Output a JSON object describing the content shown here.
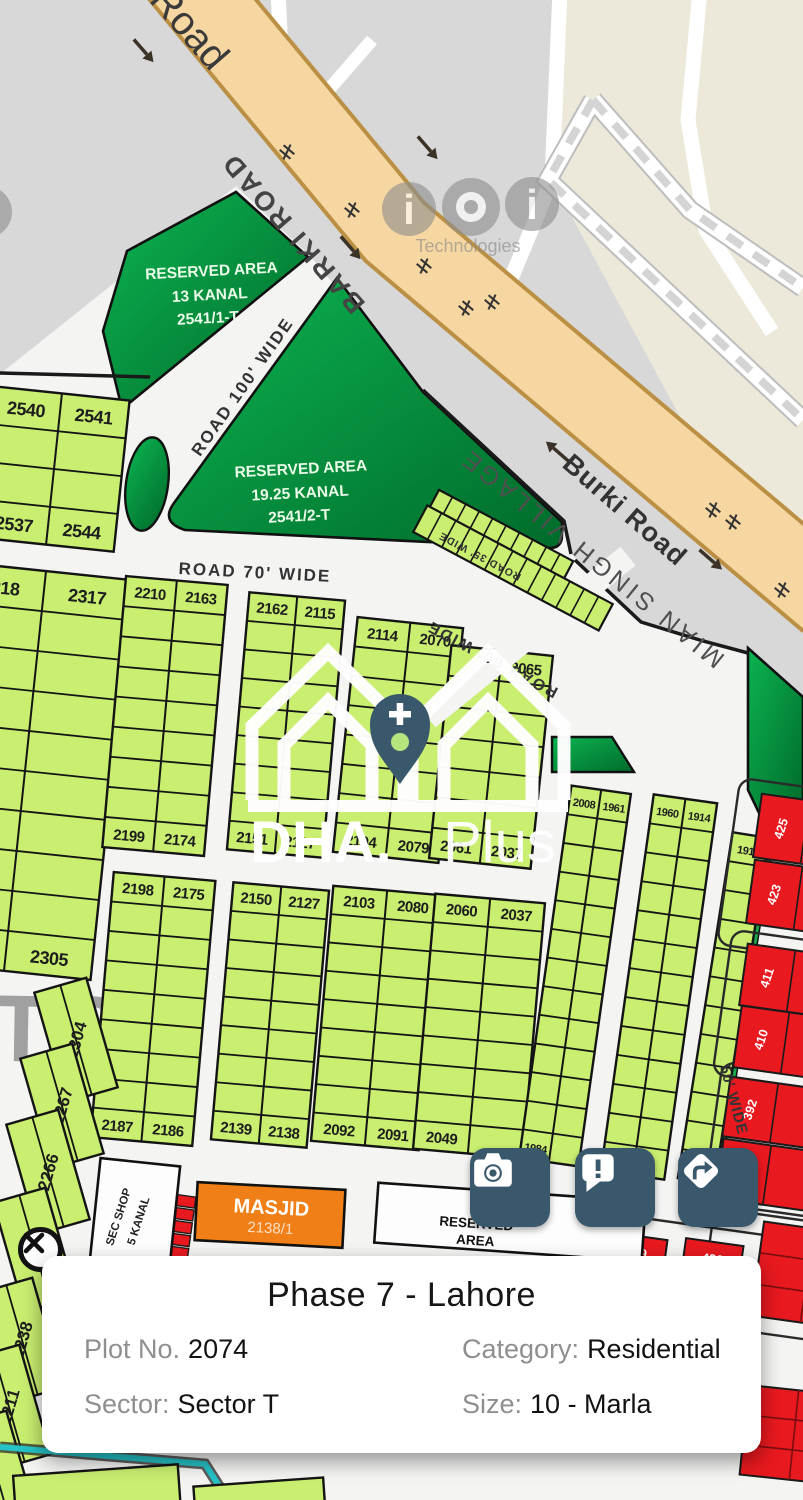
{
  "map": {
    "roads": {
      "burki": "Burki Road",
      "barki": "BARKI ROAD",
      "road100": "ROAD 100' WIDE",
      "road70": "ROAD 70' WIDE",
      "road60": "ROAD 60' WIDE",
      "road50": "50' WIDE",
      "road35": "ROAD 35' WIDE"
    },
    "village": "MIAN SINGH VILLAGE",
    "sector_watermark": "TOR",
    "reserved1": {
      "l1": "RESERVED AREA",
      "l2": "13 KANAL",
      "l3": "2541/1-T"
    },
    "reserved2": {
      "l1": "RESERVED AREA",
      "l2": "19.25 KANAL",
      "l3": "2541/2-T"
    },
    "reserved_bottom": {
      "l1": "RESERVED",
      "l2": "AREA"
    },
    "masjid": {
      "l1": "MASJID",
      "l2": "2138/1"
    },
    "secshop": {
      "l1": "SEC SHOP",
      "l2": "5 KANAL"
    },
    "watermark": {
      "brand_bold": "DHA.",
      "brand_light": "Plus",
      "tech": "Technologies",
      "i_glyph": "i"
    },
    "geometry": {
      "blocks": [
        {
          "x": -14,
          "y": 393,
          "w": 136,
          "h": 152,
          "rot": 6,
          "rows": 4,
          "cols": 2,
          "tl": "2540",
          "tr": "2541",
          "bl": "2537",
          "br": "2544",
          "fs": 18
        },
        {
          "x": -62,
          "y": 570,
          "w": 174,
          "h": 402,
          "rot": 6,
          "rows": 10,
          "cols": 2,
          "tl": "2318",
          "tr": "2317",
          "bl": "",
          "br": "2305",
          "fs": 18
        },
        {
          "x": 114,
          "y": 580,
          "w": 102,
          "h": 272,
          "rot": 5,
          "rows": 9,
          "cols": 2,
          "tl": "2210",
          "tr": "2163",
          "bl": "2199",
          "br": "2174",
          "fs": 15
        },
        {
          "x": 102,
          "y": 876,
          "w": 102,
          "h": 266,
          "rot": 5,
          "rows": 9,
          "cols": 2,
          "tl": "2198",
          "tr": "2175",
          "bl": "2187",
          "br": "2186",
          "fs": 15
        },
        {
          "x": 238,
          "y": 596,
          "w": 96,
          "h": 258,
          "rot": 5,
          "rows": 9,
          "cols": 2,
          "tl": "2162",
          "tr": "2115",
          "bl": "2151",
          "br": "2127",
          "fs": 15
        },
        {
          "x": 222,
          "y": 886,
          "w": 96,
          "h": 258,
          "rot": 5,
          "rows": 9,
          "cols": 2,
          "tl": "2150",
          "tr": "2127",
          "bl": "2139",
          "br": "2138",
          "fs": 15
        },
        {
          "x": 345,
          "y": 622,
          "w": 106,
          "h": 236,
          "rot": 6,
          "rows": 8,
          "cols": 2,
          "tl": "2114",
          "tr": "2070",
          "bl": "2104",
          "br": "2079",
          "fs": 15
        },
        {
          "x": 322,
          "y": 890,
          "w": 108,
          "h": 256,
          "rot": 5,
          "rows": 9,
          "cols": 2,
          "tl": "2103",
          "tr": "2080",
          "bl": "2092",
          "br": "2091",
          "fs": 15
        },
        {
          "x": 440,
          "y": 650,
          "w": 102,
          "h": 214,
          "rot": 6,
          "rows": 7,
          "cols": 2,
          "tl": "",
          "tr": "2065",
          "bl": "2061",
          "br": "2037",
          "fs": 15
        },
        {
          "x": 424,
          "y": 898,
          "w": 110,
          "h": 256,
          "rot": 5,
          "rows": 9,
          "cols": 2,
          "tl": "2060",
          "tr": "2037",
          "bl": "2049",
          "br": "",
          "fs": 15
        },
        {
          "x": 545,
          "y": 788,
          "w": 60,
          "h": 376,
          "rot": 8,
          "rows": 13,
          "cols": 2,
          "tl": "2008",
          "tr": "1961",
          "bl": "1984",
          "br": "",
          "fs": 11
        },
        {
          "x": 627,
          "y": 797,
          "w": 64,
          "h": 380,
          "rot": 8,
          "rows": 13,
          "cols": 2,
          "tl": "1960",
          "tr": "1914",
          "bl": "",
          "br": "",
          "fs": 11
        },
        {
          "x": 705,
          "y": 833,
          "w": 37,
          "h": 350,
          "rot": 9,
          "rows": 12,
          "cols": 1,
          "tl": "1913",
          "tr": "",
          "bl": "",
          "br": "",
          "fs": 11
        }
      ],
      "strips": [
        {
          "x": 424,
          "y": 524,
          "w": 152,
          "h": 26,
          "rot": 28,
          "vcols": 10
        },
        {
          "x": 408,
          "y": 553,
          "w": 210,
          "h": 30,
          "rot": 28,
          "vcols": 13
        }
      ],
      "rot_plots": [
        {
          "n": "2304",
          "cx": 76,
          "cy": 1040
        },
        {
          "n": "2267",
          "cx": 62,
          "cy": 1106
        },
        {
          "n": "2266",
          "cx": 48,
          "cy": 1172
        },
        {
          "n": "2239",
          "cx": 35,
          "cy": 1250
        },
        {
          "n": "2238",
          "cx": 22,
          "cy": 1340
        },
        {
          "n": "2211",
          "cx": 9,
          "cy": 1407
        },
        {
          "n": "",
          "cx": -4,
          "cy": 1473
        }
      ],
      "red_plots": [
        {
          "n": "425",
          "x": 757,
          "y": 800,
          "w": 95,
          "h": 64,
          "rot": 8,
          "div": 48
        },
        {
          "n": "423",
          "x": 750,
          "y": 866,
          "w": 95,
          "h": 64,
          "rot": 8,
          "div": 48
        },
        {
          "n": "411",
          "x": 743,
          "y": 950,
          "w": 95,
          "h": 62,
          "rot": 8,
          "div": 48
        },
        {
          "n": "410",
          "x": 737,
          "y": 1012,
          "w": 95,
          "h": 62,
          "rot": 8,
          "div": 48
        },
        {
          "n": "392",
          "x": 726,
          "y": 1083,
          "w": 95,
          "h": 60,
          "rot": 8,
          "div": 48
        },
        {
          "n": "391",
          "x": 719,
          "y": 1145,
          "w": 95,
          "h": 60,
          "rot": 8,
          "div": 48
        },
        {
          "n": "449",
          "x": 608,
          "y": 1236,
          "w": 58,
          "h": 26,
          "rot": 8,
          "tdir": "h"
        },
        {
          "n": "426",
          "x": 684,
          "y": 1242,
          "w": 58,
          "h": 26,
          "rot": 8,
          "tdir": "h"
        }
      ],
      "red_grids": [
        {
          "x": 757,
          "y": 1228,
          "w": 100,
          "h": 95,
          "rot": 8,
          "gx": 2,
          "gy": 3
        },
        {
          "x": 744,
          "y": 1390,
          "w": 100,
          "h": 90,
          "rot": 6,
          "gx": 2,
          "gy": 3
        }
      ],
      "street_outlines": [
        {
          "x": 728,
          "y": 786,
          "w": 130,
          "h": 168,
          "rot": 8
        },
        {
          "x": 722,
          "y": 938,
          "w": 130,
          "h": 146,
          "rot": 8
        },
        {
          "x": 712,
          "y": 1070,
          "w": 130,
          "h": 146,
          "rot": 8
        },
        {
          "x": 596,
          "y": 1224,
          "w": 176,
          "h": 50,
          "rot": 8
        },
        {
          "x": 706,
          "y": 1212,
          "w": 130,
          "h": 122,
          "rot": 8
        }
      ],
      "ticks": [
        [
          287,
          152
        ],
        [
          352,
          210
        ],
        [
          424,
          266
        ],
        [
          466,
          308
        ],
        [
          713,
          510
        ],
        [
          733,
          522
        ],
        [
          782,
          590
        ],
        [
          492,
          302
        ]
      ],
      "arrows": [
        [
          143,
          50,
          49
        ],
        [
          427,
          147,
          49
        ],
        [
          350,
          247,
          49
        ],
        [
          558,
          452,
          221
        ],
        [
          710,
          559,
          41
        ]
      ],
      "red_stack": {
        "x": 150,
        "y": 1194,
        "w": 42,
        "h": 11,
        "n": 5,
        "rot": 8
      },
      "bottom_plots": [
        {
          "x": 15,
          "y": 1470,
          "w": 165,
          "h": 60,
          "rot": -4
        },
        {
          "x": 195,
          "y": 1482,
          "w": 130,
          "h": 50,
          "rot": -4
        }
      ]
    },
    "colors": {
      "plot_green": "#c9ee70",
      "reserved_green_1": "#00a84c",
      "reserved_green_2": "#00702c",
      "road_tan": "#f6d7a1",
      "road_tan_edge": "#bb9045",
      "red_plot": "#e8191f",
      "masjid_orange": "#ef7f16",
      "button_teal": "#3a586c",
      "cyan_boundary": "#25c2c6"
    }
  },
  "buttons": [
    {
      "name": "camera"
    },
    {
      "name": "report"
    },
    {
      "name": "directions"
    }
  ],
  "card": {
    "title": "Phase 7 - Lahore",
    "plot_label": "Plot No.",
    "plot_value": "2074",
    "category_label": "Category:",
    "category_value": "Residential",
    "sector_label": "Sector:",
    "sector_value": "Sector T",
    "size_label": "Size:",
    "size_value": "10 - Marla",
    "close_glyph": "✕"
  }
}
